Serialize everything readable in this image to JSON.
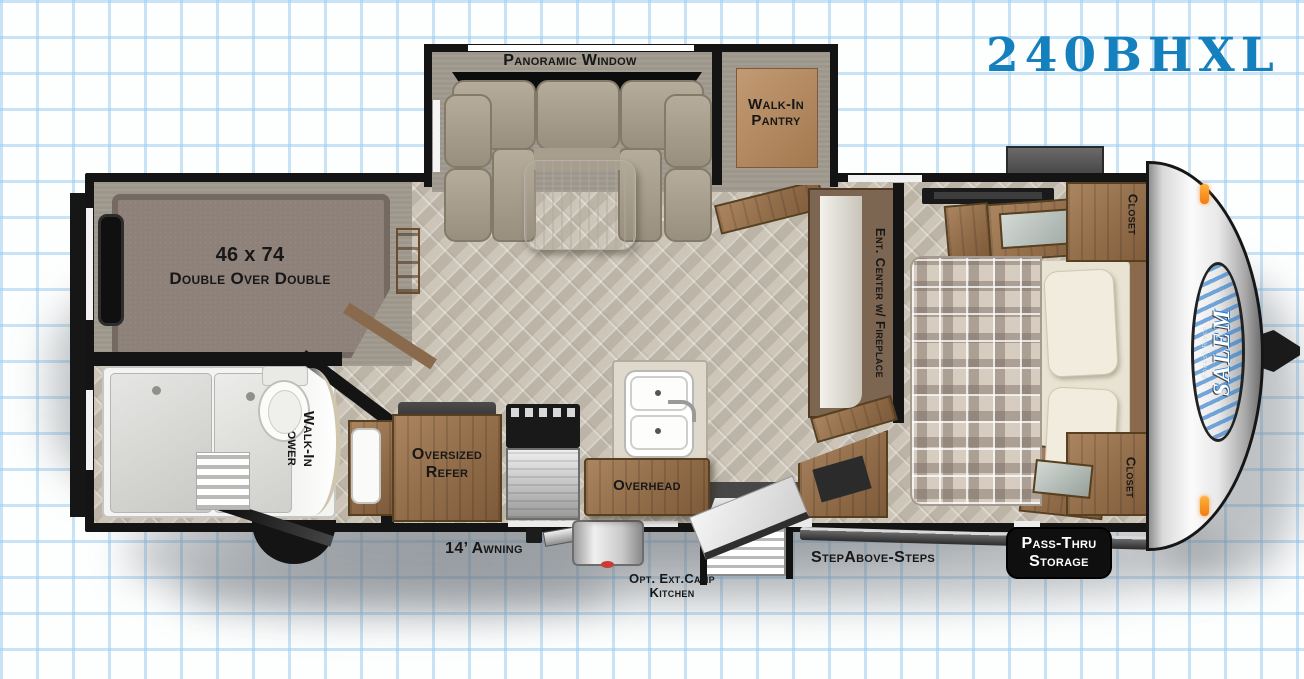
{
  "title": "240BHXL",
  "colors": {
    "accent": "#1480bd",
    "wall": "#141414"
  },
  "labels": {
    "panoramic_window": "Panoramic Window",
    "pantry_1": "Walk-In",
    "pantry_2": "Pantry",
    "bunk_size": "46 x 74",
    "bunk_type": "Double Over Double",
    "shower_1": "Walk-In",
    "shower_2": "Shower",
    "refer_1": "Oversized",
    "refer_2": "Refer",
    "overhead": "Overhead",
    "ent_center": "Ent. Center w/ Fireplace",
    "closet_top": "Closet",
    "closet_bottom": "Closet"
  },
  "exterior": {
    "awning": "14’ Awning",
    "camp_kitchen_1": "Opt. Ext.Camp",
    "camp_kitchen_2": "Kitchen",
    "steps": "StepAbove-Steps",
    "pass_thru_1": "Pass-Thru",
    "pass_thru_2": "Storage"
  },
  "brand": {
    "name": "SALEM",
    "sub": "Forest River"
  }
}
